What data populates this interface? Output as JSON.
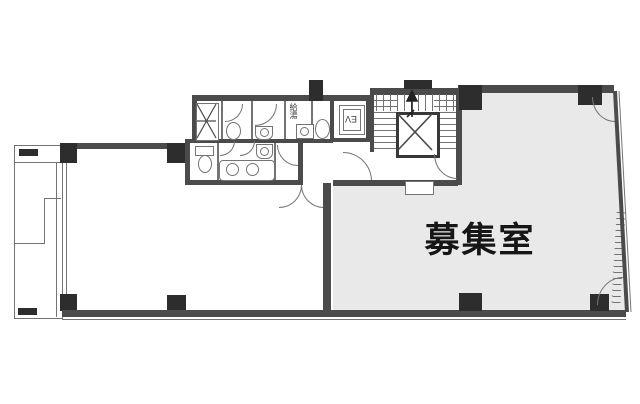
{
  "labels": {
    "vacant_room": "募集室",
    "elevator": "EV",
    "kitchenette": "給湯"
  },
  "colors": {
    "wall": "#4b4b4b",
    "pillar": "#2d2d2d",
    "line": "#747474",
    "roomfill": "#e9e9e9",
    "bg": "#ffffff",
    "text": "#161616"
  }
}
